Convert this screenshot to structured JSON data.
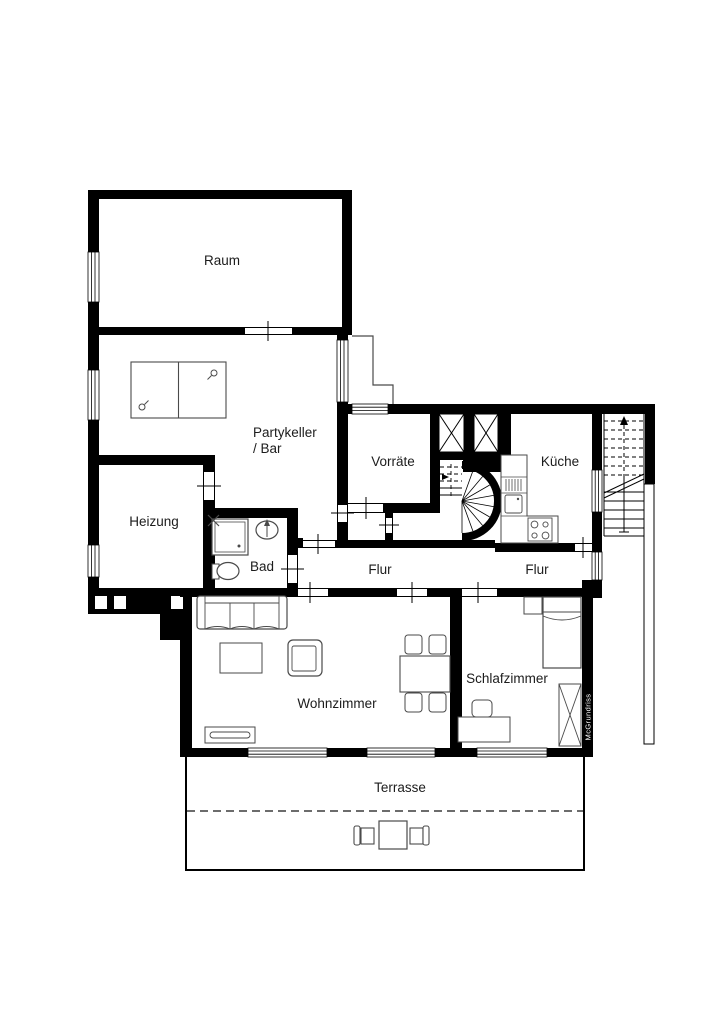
{
  "floorplan": {
    "rooms": {
      "raum": "Raum",
      "partykeller": "Partykeller\n/ Bar",
      "vorraete": "Vorräte",
      "kueche": "Küche",
      "heizung": "Heizung",
      "bad": "Bad",
      "flur_a": "Flur",
      "flur_b": "Flur",
      "wohnzimmer": "Wohnzimmer",
      "schlafzimmer": "Schlafzimmer",
      "terrasse": "Terrasse"
    },
    "watermark": "McGrundriss",
    "colors": {
      "wall": "#000000",
      "background": "#ffffff",
      "furniture_stroke": "#4a4a4a"
    }
  }
}
